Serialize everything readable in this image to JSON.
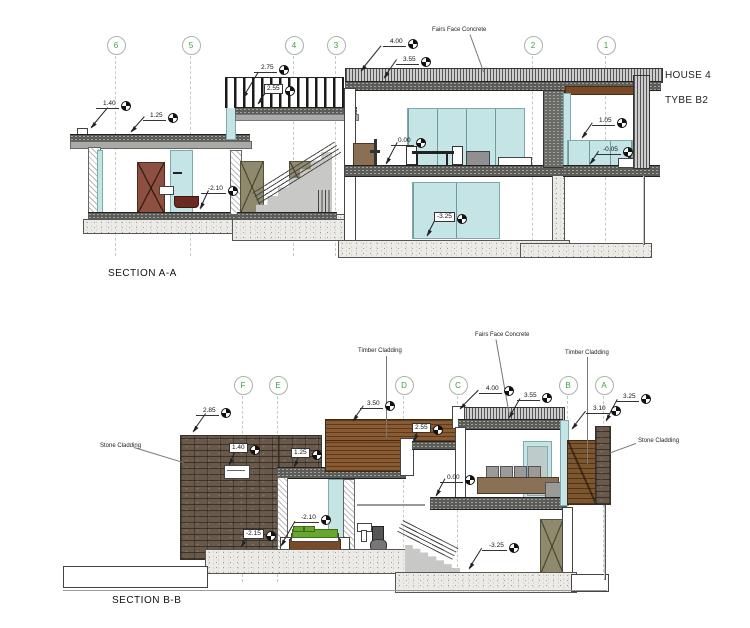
{
  "title": {
    "house": "HOUSE 4",
    "type": "TYBE B2"
  },
  "section_a": {
    "label": "SECTION A-A",
    "grids": [
      {
        "label": "6"
      },
      {
        "label": "5"
      },
      {
        "label": "4"
      },
      {
        "label": "3"
      },
      {
        "label": "2"
      },
      {
        "label": "1"
      }
    ],
    "levels": [
      {
        "value": "1.40"
      },
      {
        "value": "1.25"
      },
      {
        "value": "2.75"
      },
      {
        "value": "2.55"
      },
      {
        "value": "4.00"
      },
      {
        "value": "3.55"
      },
      {
        "value": "0.00"
      },
      {
        "value": "-2.10"
      },
      {
        "value": "-3.25"
      },
      {
        "value": "1.05"
      },
      {
        "value": "-0.05"
      }
    ],
    "notes": [
      {
        "text": "Fairs Face Concrete"
      }
    ]
  },
  "section_b": {
    "label": "SECTION B-B",
    "grids": [
      {
        "label": "F"
      },
      {
        "label": "E"
      },
      {
        "label": "D"
      },
      {
        "label": "C"
      },
      {
        "label": "B"
      },
      {
        "label": "A"
      }
    ],
    "levels": [
      {
        "value": "2.85"
      },
      {
        "value": "3.50"
      },
      {
        "value": "4.00"
      },
      {
        "value": "3.55"
      },
      {
        "value": "3.25"
      },
      {
        "value": "3.10"
      },
      {
        "value": "2.55"
      },
      {
        "value": "1.40"
      },
      {
        "value": "1.25"
      },
      {
        "value": "0.00"
      },
      {
        "value": "-2.10"
      },
      {
        "value": "-2.15"
      },
      {
        "value": "-3.25"
      }
    ],
    "notes": [
      {
        "text": "Timber Cladding"
      },
      {
        "text": "Fairs Face Concrete"
      },
      {
        "text": "Timber Cladding"
      },
      {
        "text": "Stone Cladding"
      },
      {
        "text": "Stone Cladding"
      }
    ]
  },
  "colors": {
    "grid_label": "#3f9e3f",
    "glass": "#c5e4e6",
    "timber": "#8a5a33",
    "stone": "#68594b",
    "bed_green": "#67a72e",
    "vanity_red": "#6b2a24",
    "door_brown": "#8d4f3f",
    "door_olive": "#8f8a6d"
  }
}
